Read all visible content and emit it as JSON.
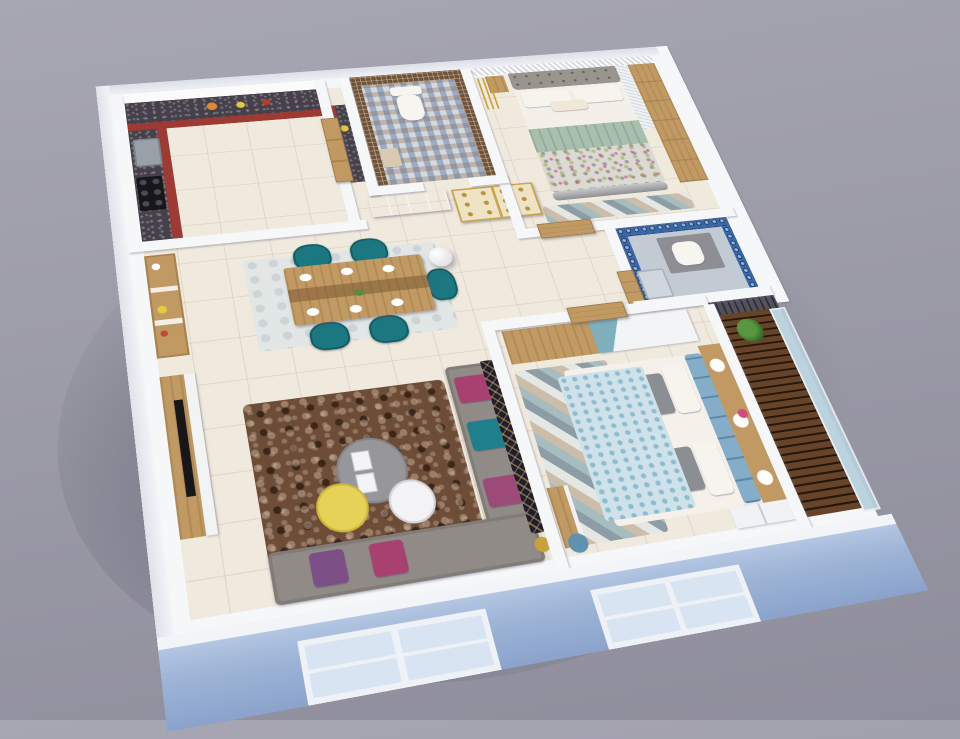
{
  "scene": {
    "title": "3D isometric cutaway floor plan render of a 2BHK apartment",
    "view": "aerial cutaway, walls sliced, rotated perspective",
    "background_top": "#a7a6b3",
    "background_bottom": "#8e8d9b",
    "exterior_front_wall": "#9db4d6",
    "wall_top": "#f6f7f9",
    "floor_tile": "#f0e9dd",
    "front_window_count": 2
  },
  "rooms": {
    "kitchen": {
      "name": "Kitchen",
      "position": "back-left",
      "features": [
        "L-shaped granite counter",
        "red base cabinets",
        "white upper cabinets",
        "black gas hob",
        "sink",
        "fruit bowls",
        "wash counter nook",
        "wooden entry door"
      ],
      "cabinet_red": "#9c3a33",
      "granite": "#45404a"
    },
    "wc": {
      "name": "Toilet / WC",
      "position": "back-center",
      "features": [
        "brown mosaic walls",
        "white commode",
        "patterned encaustic tile floor",
        "side stool with towels"
      ],
      "mosaic_brown": "#6e523a"
    },
    "master_bedroom": {
      "name": "Bedroom 1",
      "position": "back-right",
      "features": [
        "double bed",
        "grey tufted headboard",
        "white pillows",
        "sage green throw",
        "flecked duvet",
        "silver footboard bench",
        "light-oak wardrobe",
        "sketch-print panel",
        "3D diamond accent wall",
        "gold pendant cluster",
        "triangle foot rug",
        "bedside table"
      ],
      "throw_green": "#a9bfae",
      "wardrobe_wood": "#d6b88c",
      "accent_wall": "#e9e8ee"
    },
    "bathroom": {
      "name": "Bathroom",
      "position": "right-middle",
      "features": [
        "blue floral mosaic walls",
        "grey partition",
        "white commode",
        "shower with tray",
        "vanity counter"
      ],
      "wall_blue": "#3a67a5"
    },
    "foyer": {
      "name": "Foyer / Passage",
      "position": "center",
      "features": [
        "four-panel tree painting",
        "golden-accent crockery cabinet",
        "white woven pendant lamp",
        "wooden doors to both bedrooms"
      ],
      "cabinet_gold": "#caa54b"
    },
    "dining": {
      "name": "Dining",
      "position": "left-middle",
      "features": [
        "wooden dining table with plates",
        "five teal tufted chairs",
        "pale rug",
        "wooden wall niche with jars",
        "white sphere pendant"
      ],
      "chair_teal": "#1b7780",
      "table_wood": "#c79c60"
    },
    "living": {
      "name": "Living Room",
      "position": "front-left",
      "features": [
        "grey L-shaped sofa",
        "magenta, teal and purple cushions",
        "brown shag rug",
        "nesting round coffee tables grey yellow white",
        "TV unit with wall-mounted TV",
        "black-gold lattice partition",
        "gold table lamp",
        "two front windows"
      ],
      "sofa_grey": "#908b87",
      "rug_brown": "#6d4c38",
      "table_yellow": "#e5d257"
    },
    "bedroom2": {
      "name": "Bedroom 2",
      "position": "front-right",
      "features": [
        "double bed",
        "blue tufted headboard",
        "light-blue ring-pattern duvet",
        "white and printed pillows",
        "wooden circle-niche wall panel with flowers",
        "two-tone wardrobe oak and white with teal triangle",
        "geometric triangle rug",
        "window bench",
        "blue round stool",
        "white chest of drawers"
      ],
      "headboard_blue": "#84adca",
      "duvet_blue": "#cfe2ea",
      "wardrobe_teal": "#7fb0bd"
    },
    "balcony": {
      "name": "Balcony",
      "position": "right-edge",
      "features": [
        "dark wood deck planks",
        "blue glass railing",
        "potted green plant",
        "slate stone accent wall"
      ],
      "deck_brown": "#50341f",
      "slate_grey": "#55525c",
      "glass": "#b7cfdd"
    }
  }
}
